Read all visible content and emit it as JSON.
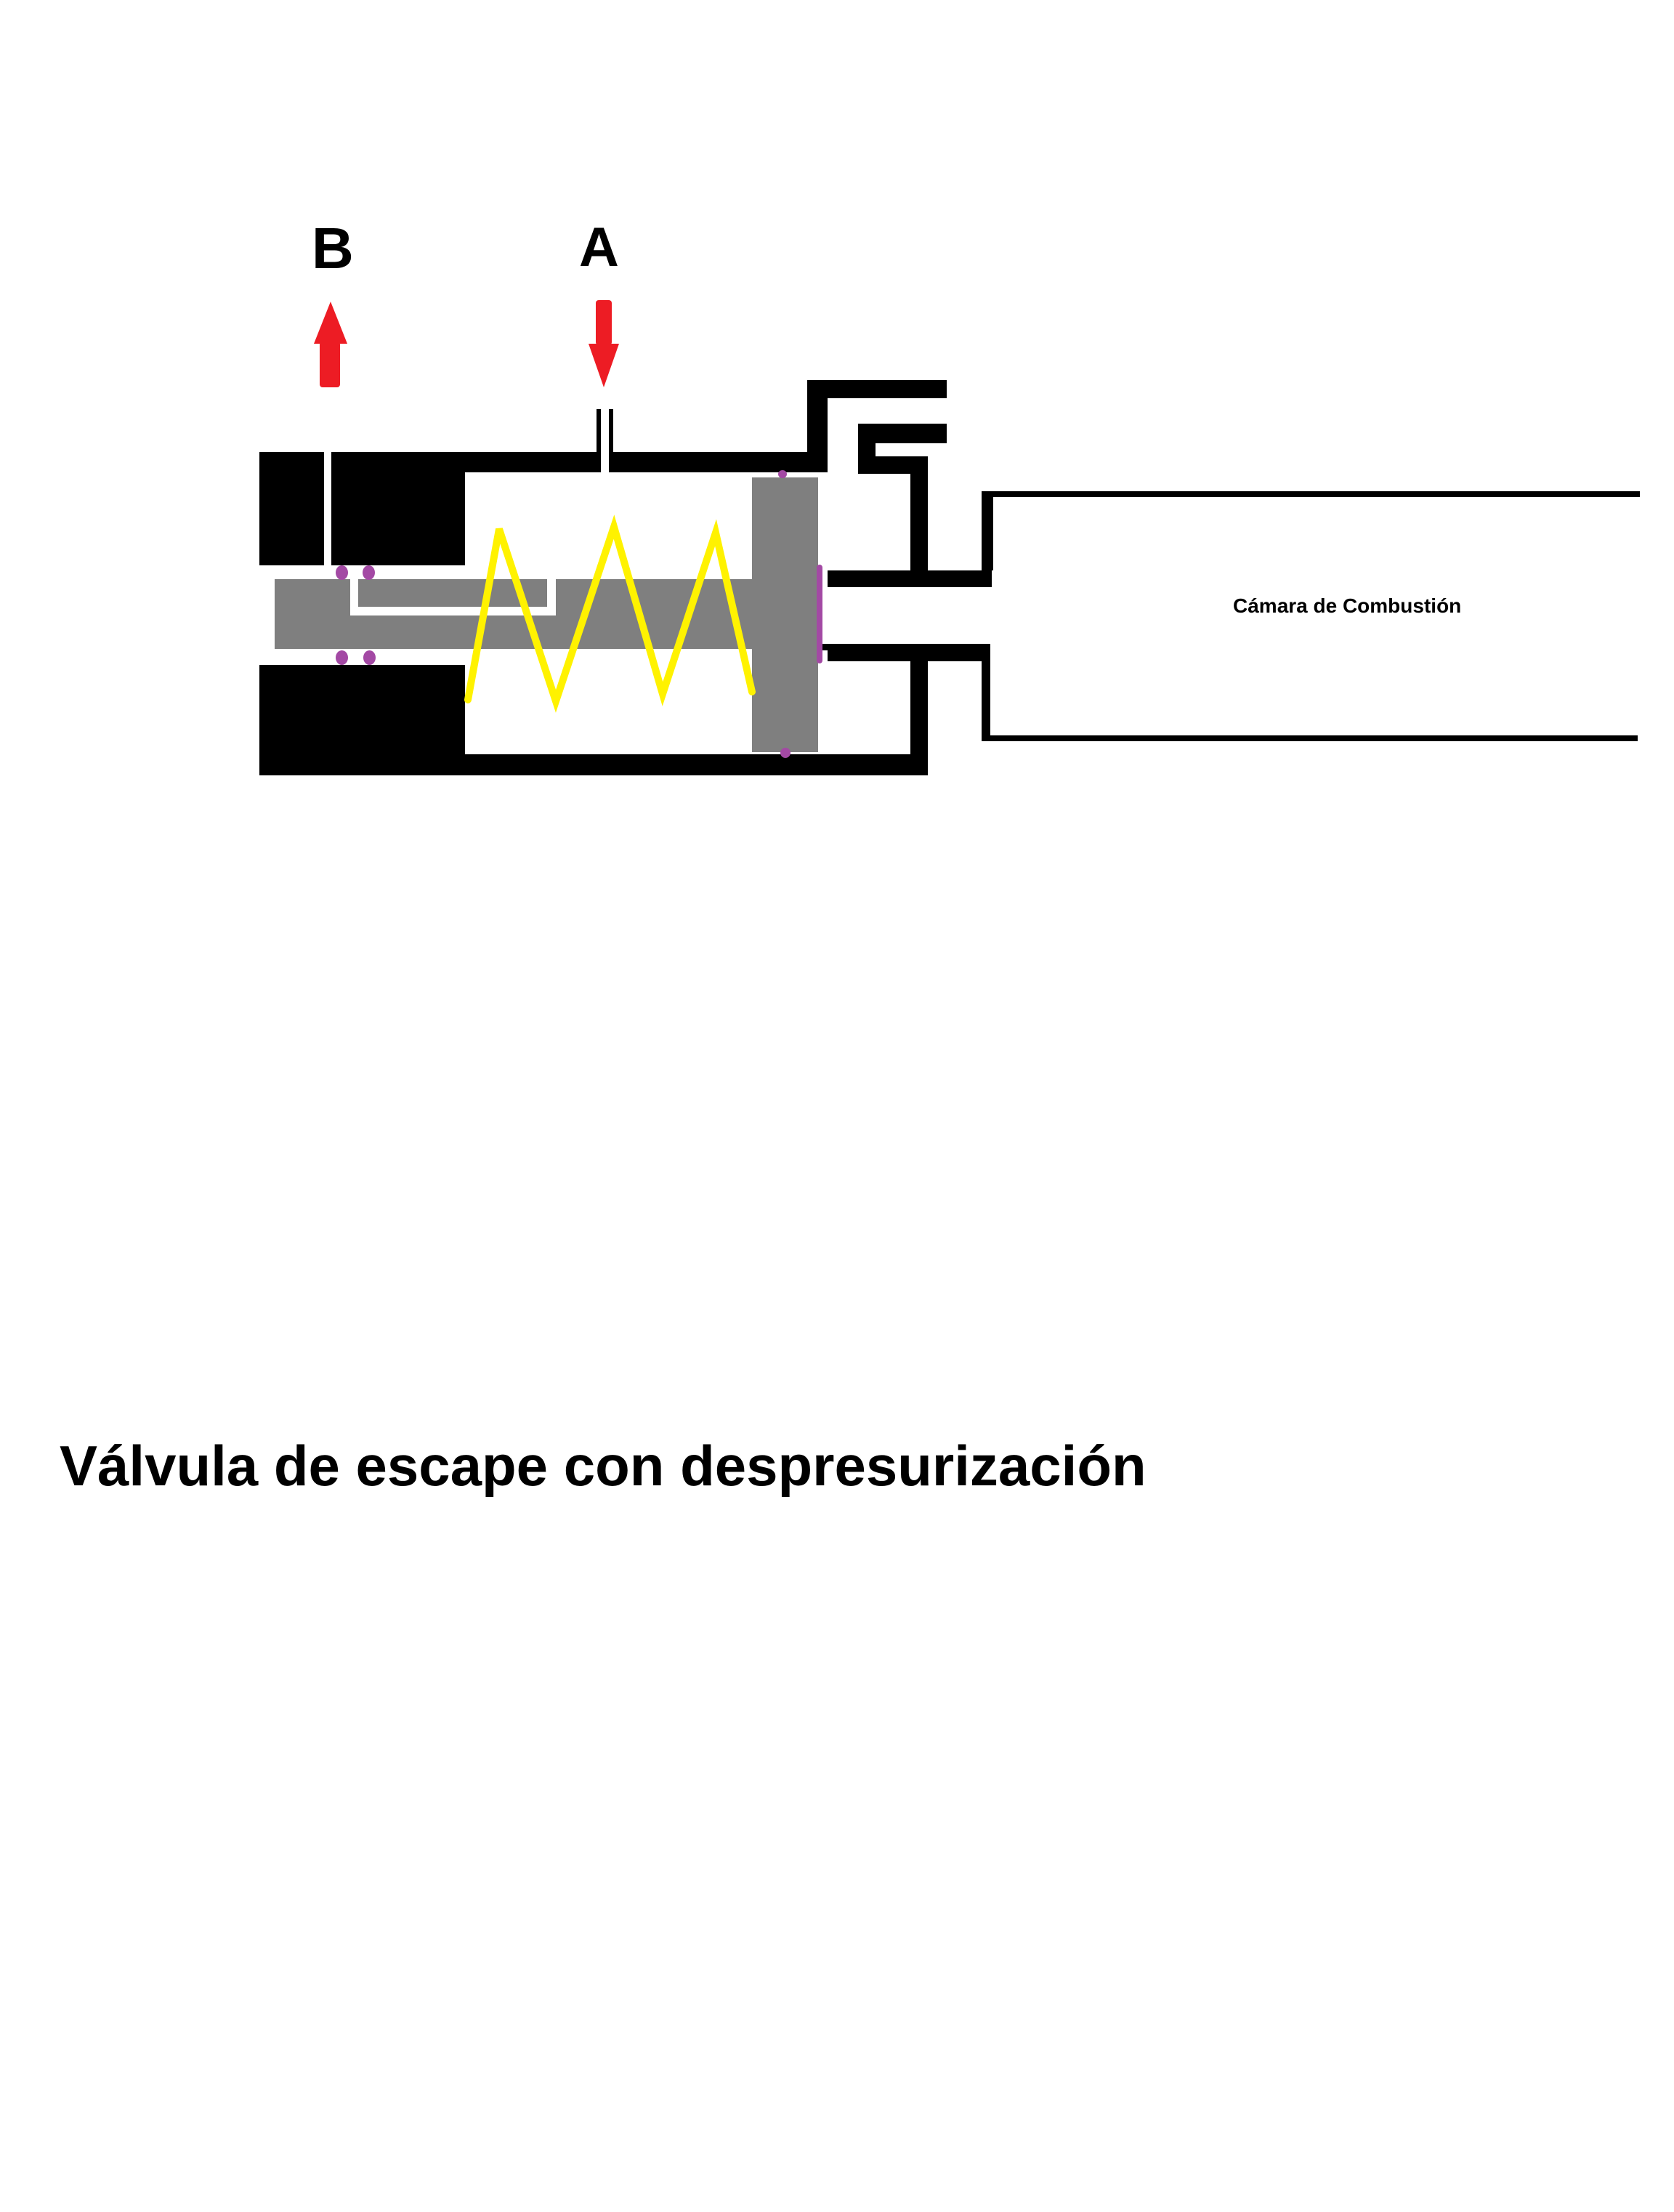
{
  "title": "Válvula de escape con despresurización",
  "labels": {
    "port_b": "B",
    "port_a": "A",
    "chamber": "Cámara de Combustión"
  },
  "colors": {
    "background": "#FFFFFF",
    "outline": "#000000",
    "text": "#000000",
    "spool": "#7F7F7F",
    "spring": "#FFF200",
    "arrow": "#ED1C24",
    "seal": "#A349A4"
  }
}
